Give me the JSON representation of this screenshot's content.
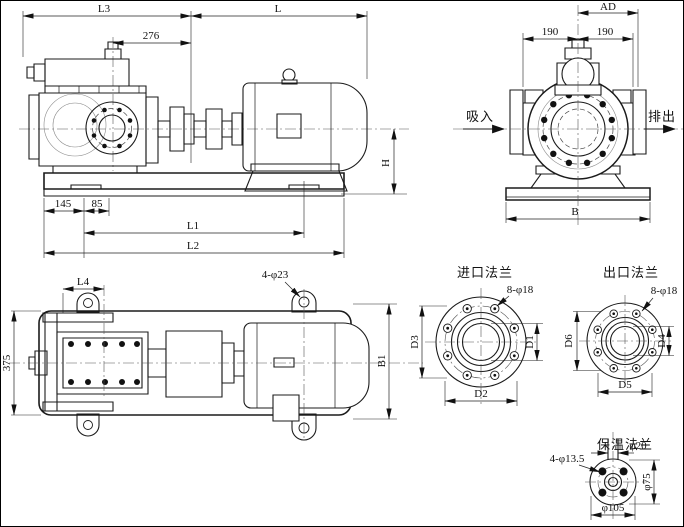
{
  "drawing": {
    "colors": {
      "ink": "#1b1b1b",
      "paper": "#ffffff"
    },
    "side_view": {
      "dims": {
        "L3": "L3",
        "d276": "276",
        "L": "L",
        "H": "H",
        "d145": "145",
        "d85": "85",
        "L1": "L1",
        "L2": "L2"
      }
    },
    "front_view": {
      "dims": {
        "AD": "AD",
        "left190": "190",
        "right190": "190",
        "B": "B"
      },
      "labels": {
        "suction": "吸入",
        "discharge": "排出"
      }
    },
    "top_view": {
      "dims": {
        "L4": "L4",
        "holes": "4-φ23",
        "d375": "375",
        "B1": "B1"
      }
    },
    "inlet_flange": {
      "title": "进口法兰",
      "dims": {
        "holes": "8-φ18",
        "D1": "D1",
        "D2": "D2",
        "D3": "D3"
      }
    },
    "outlet_flange": {
      "title": "出口法兰",
      "dims": {
        "holes": "8-φ18",
        "D4": "D4",
        "D5": "D5",
        "D6": "D6"
      }
    },
    "insulation_flange": {
      "title": "保温法兰",
      "dims": {
        "holes": "4-φ13.5",
        "d20": "φ20",
        "d75": "φ75",
        "d105": "φ105"
      }
    }
  }
}
